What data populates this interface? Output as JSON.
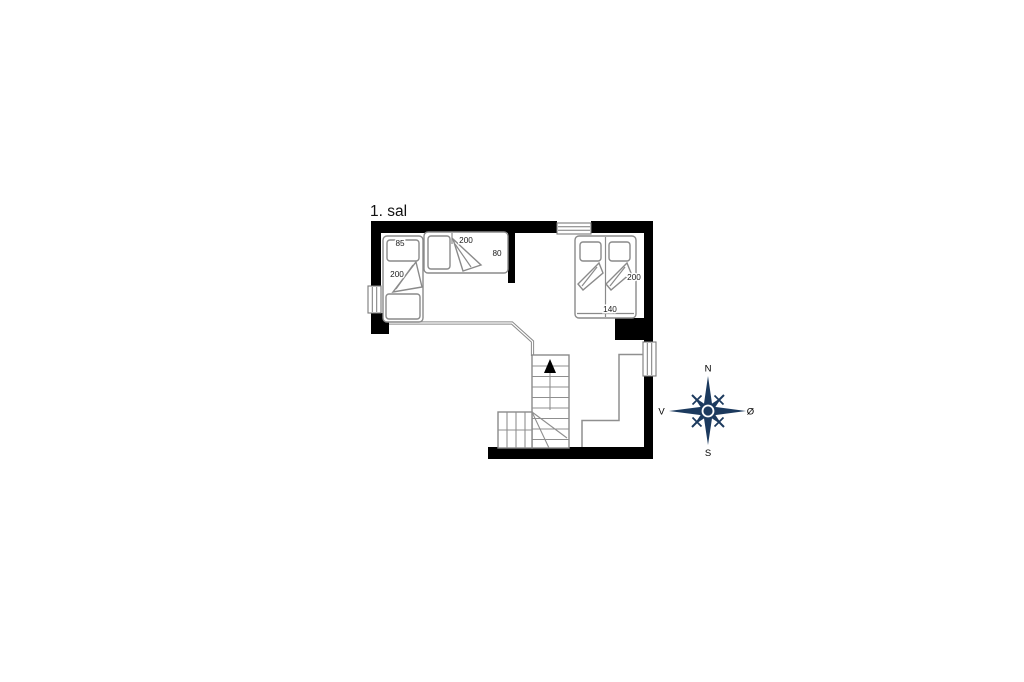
{
  "title": "1. sal",
  "floor_plan": {
    "beds": {
      "single_left": {
        "width_cm": "85",
        "length_cm": "200"
      },
      "single_top": {
        "length_cm": "200",
        "width_cm": "80"
      },
      "double": {
        "length_cm": "200",
        "width_cm": "140"
      }
    },
    "stairs": {
      "direction": "up"
    }
  },
  "compass": {
    "north": "N",
    "south": "S",
    "west": "V",
    "east": "Ø"
  },
  "colors": {
    "wall": "#000000",
    "furniture_line": "#8a8a8a",
    "compass_navy": "#1c3a5e",
    "background": "#ffffff"
  }
}
